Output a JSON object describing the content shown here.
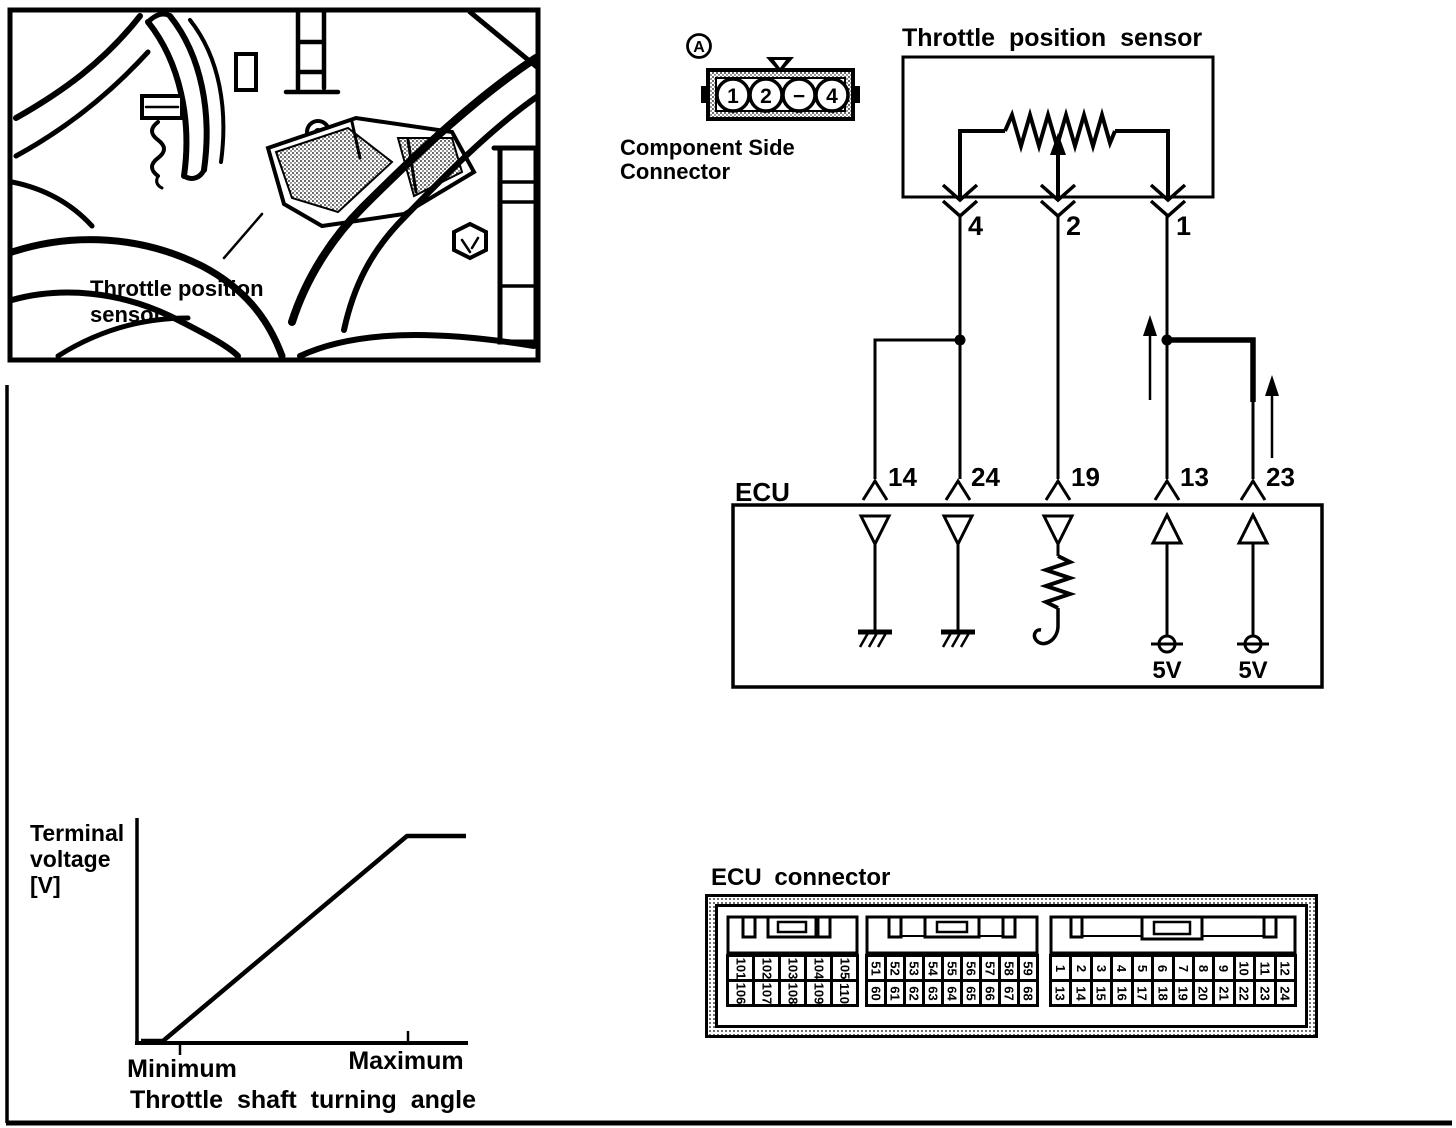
{
  "photo": {
    "caption_lines": [
      "Throttle position",
      "sensor"
    ]
  },
  "component_connector": {
    "ref_label": "A",
    "caption_lines": [
      "Component Side",
      "Connector"
    ],
    "pins": [
      "1",
      "2",
      "−",
      "4"
    ]
  },
  "sensor_schematic": {
    "title": "Throttle position sensor",
    "pins": [
      "4",
      "2",
      "1"
    ]
  },
  "ecu_schematic": {
    "label": "ECU",
    "pins": [
      "14",
      "24",
      "19",
      "13",
      "23"
    ],
    "supplies": [
      "5V",
      "5V"
    ]
  },
  "graph": {
    "ylabel_lines": [
      "Terminal",
      "voltage",
      "[V]"
    ],
    "xlabel": "Throttle shaft turning angle",
    "xticks": [
      "Minimum",
      "Maximum"
    ]
  },
  "chart_data": {
    "type": "line",
    "title": "",
    "xlabel": "Throttle shaft turning angle",
    "ylabel": "Terminal voltage [V]",
    "x_tick_labels": [
      "Minimum",
      "Maximum"
    ],
    "y_tick_labels": [],
    "grid": false,
    "legend": false,
    "series": [
      {
        "name": "terminal_voltage_vs_throttle_angle",
        "points_normalized": [
          [
            0.0,
            0.0
          ],
          [
            0.09,
            0.0
          ],
          [
            0.81,
            1.0
          ],
          [
            1.0,
            1.0
          ]
        ],
        "description": "Terminal voltage rises linearly from Minimum to Maximum throttle shaft angle, then saturates flat"
      }
    ]
  },
  "ecu_connector": {
    "title": "ECU connector",
    "blocks": [
      {
        "top": [
          "101",
          "102",
          "103",
          "104",
          "105"
        ],
        "bottom": [
          "106",
          "107",
          "108",
          "109",
          "110"
        ]
      },
      {
        "top": [
          "51",
          "52",
          "53",
          "54",
          "55",
          "56",
          "57",
          "58",
          "59"
        ],
        "bottom": [
          "60",
          "61",
          "62",
          "63",
          "64",
          "65",
          "66",
          "67",
          "68"
        ]
      },
      {
        "top": [
          "1",
          "2",
          "3",
          "4",
          "5",
          "6",
          "7",
          "8",
          "9",
          "10",
          "11",
          "12"
        ],
        "bottom": [
          "13",
          "14",
          "15",
          "16",
          "17",
          "18",
          "19",
          "20",
          "21",
          "22",
          "23",
          "24"
        ]
      }
    ]
  }
}
